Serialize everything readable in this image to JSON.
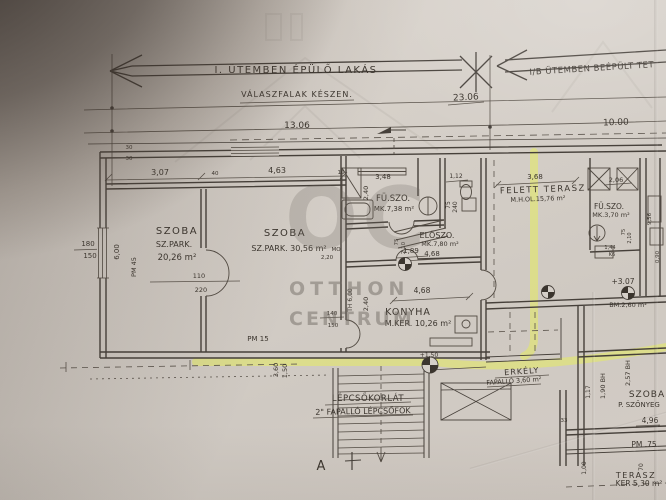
{
  "watermark": {
    "logo": "OC",
    "line1": "OTTHON",
    "line2": "CENTRUM"
  },
  "colors": {
    "highlighter": "#e7f055",
    "ink": "#46403a",
    "paper": "#d5cfc8"
  },
  "texts": {
    "arrowLeft1": "I. ÜTEMBEN ÉPÜLŐ LAKÁS",
    "arrowLeft2": "VÁLASZFALAK KÉSZEN.",
    "arrowRight1": "I/B ÜTEMBEN BEÉPÜLT TET",
    "d2306": "23.06",
    "d1306": "13.06",
    "d1000": "10.00",
    "t30a": "30",
    "t30b": "30",
    "t40": "40",
    "t10": "10",
    "d307": "3,07",
    "d463": "4,63",
    "w180": "180",
    "w150": "150",
    "d600": "6,00",
    "pm45": "PM 45",
    "szoba1a": "SZOBA",
    "szoba1b": "SZ.PARK.",
    "szoba1c": "20,26 m²",
    "door110": "110",
    "door220": "220",
    "szoba2a": "SZOBA",
    "szoba2b": "SZ.PARK. 30,56 m²",
    "mo": "MO",
    "d220": "2,20",
    "pm15": "PM 15",
    "fsz1a": "FÜ.SZO.",
    "fsz1b": "MK.7,38 m²",
    "d348": "3,48",
    "d240a": "2,40",
    "d112": "1,12",
    "wc75": "75",
    "wc240": "240",
    "elo1": "ELŐSZO.",
    "elo2": "MK.7,80 m²",
    "d189": "1,89",
    "h75": "75",
    "h210": "2,10",
    "d468a": "4,68",
    "d468b": "4,68",
    "kony1": "KONYHA",
    "kony2": "M.KER. 10,26 m²",
    "d240b": "2,40",
    "th600": "TH 6,00",
    "f140": "140",
    "f150": "150",
    "d360v": "3,60",
    "d150v": "1,50",
    "ft1": "FELETT TERASZ",
    "ft2": "M.H.OL.15,76 m²",
    "d368": "3,68",
    "d206": "2,06",
    "fsz2a": "FÜ.SZO.",
    "fsz2b": "MK.3,70 m²",
    "t144": "1,44",
    "tk6": "K6",
    "v75b": "75",
    "v210b": "2,10",
    "v956": "9,56",
    "v090": "0,90",
    "lvl307": "+3.07",
    "bm260": "BM.2,60 m²",
    "lvl150": "+1,50",
    "erk1": "ERKÉLY",
    "erk2": "FAPALLÓ 3,60 m²",
    "lep1": "LÉPCSŐKORLÁT",
    "lep2": "2\" FAPALLÓ LÉPCSŐFOK",
    "secA": "A",
    "sz3a": "SZOBA",
    "sz3b": "P. SZŐNYEG",
    "v190": "1,90 BH",
    "v257": "2,57 BH",
    "v117": "1,17",
    "d496": "4,96",
    "t33": "33",
    "pm75": "PM .75",
    "v100": "1,00",
    "v70": "70",
    "ter1": "TERASZ",
    "ter2": "KER 5,30 m²"
  }
}
